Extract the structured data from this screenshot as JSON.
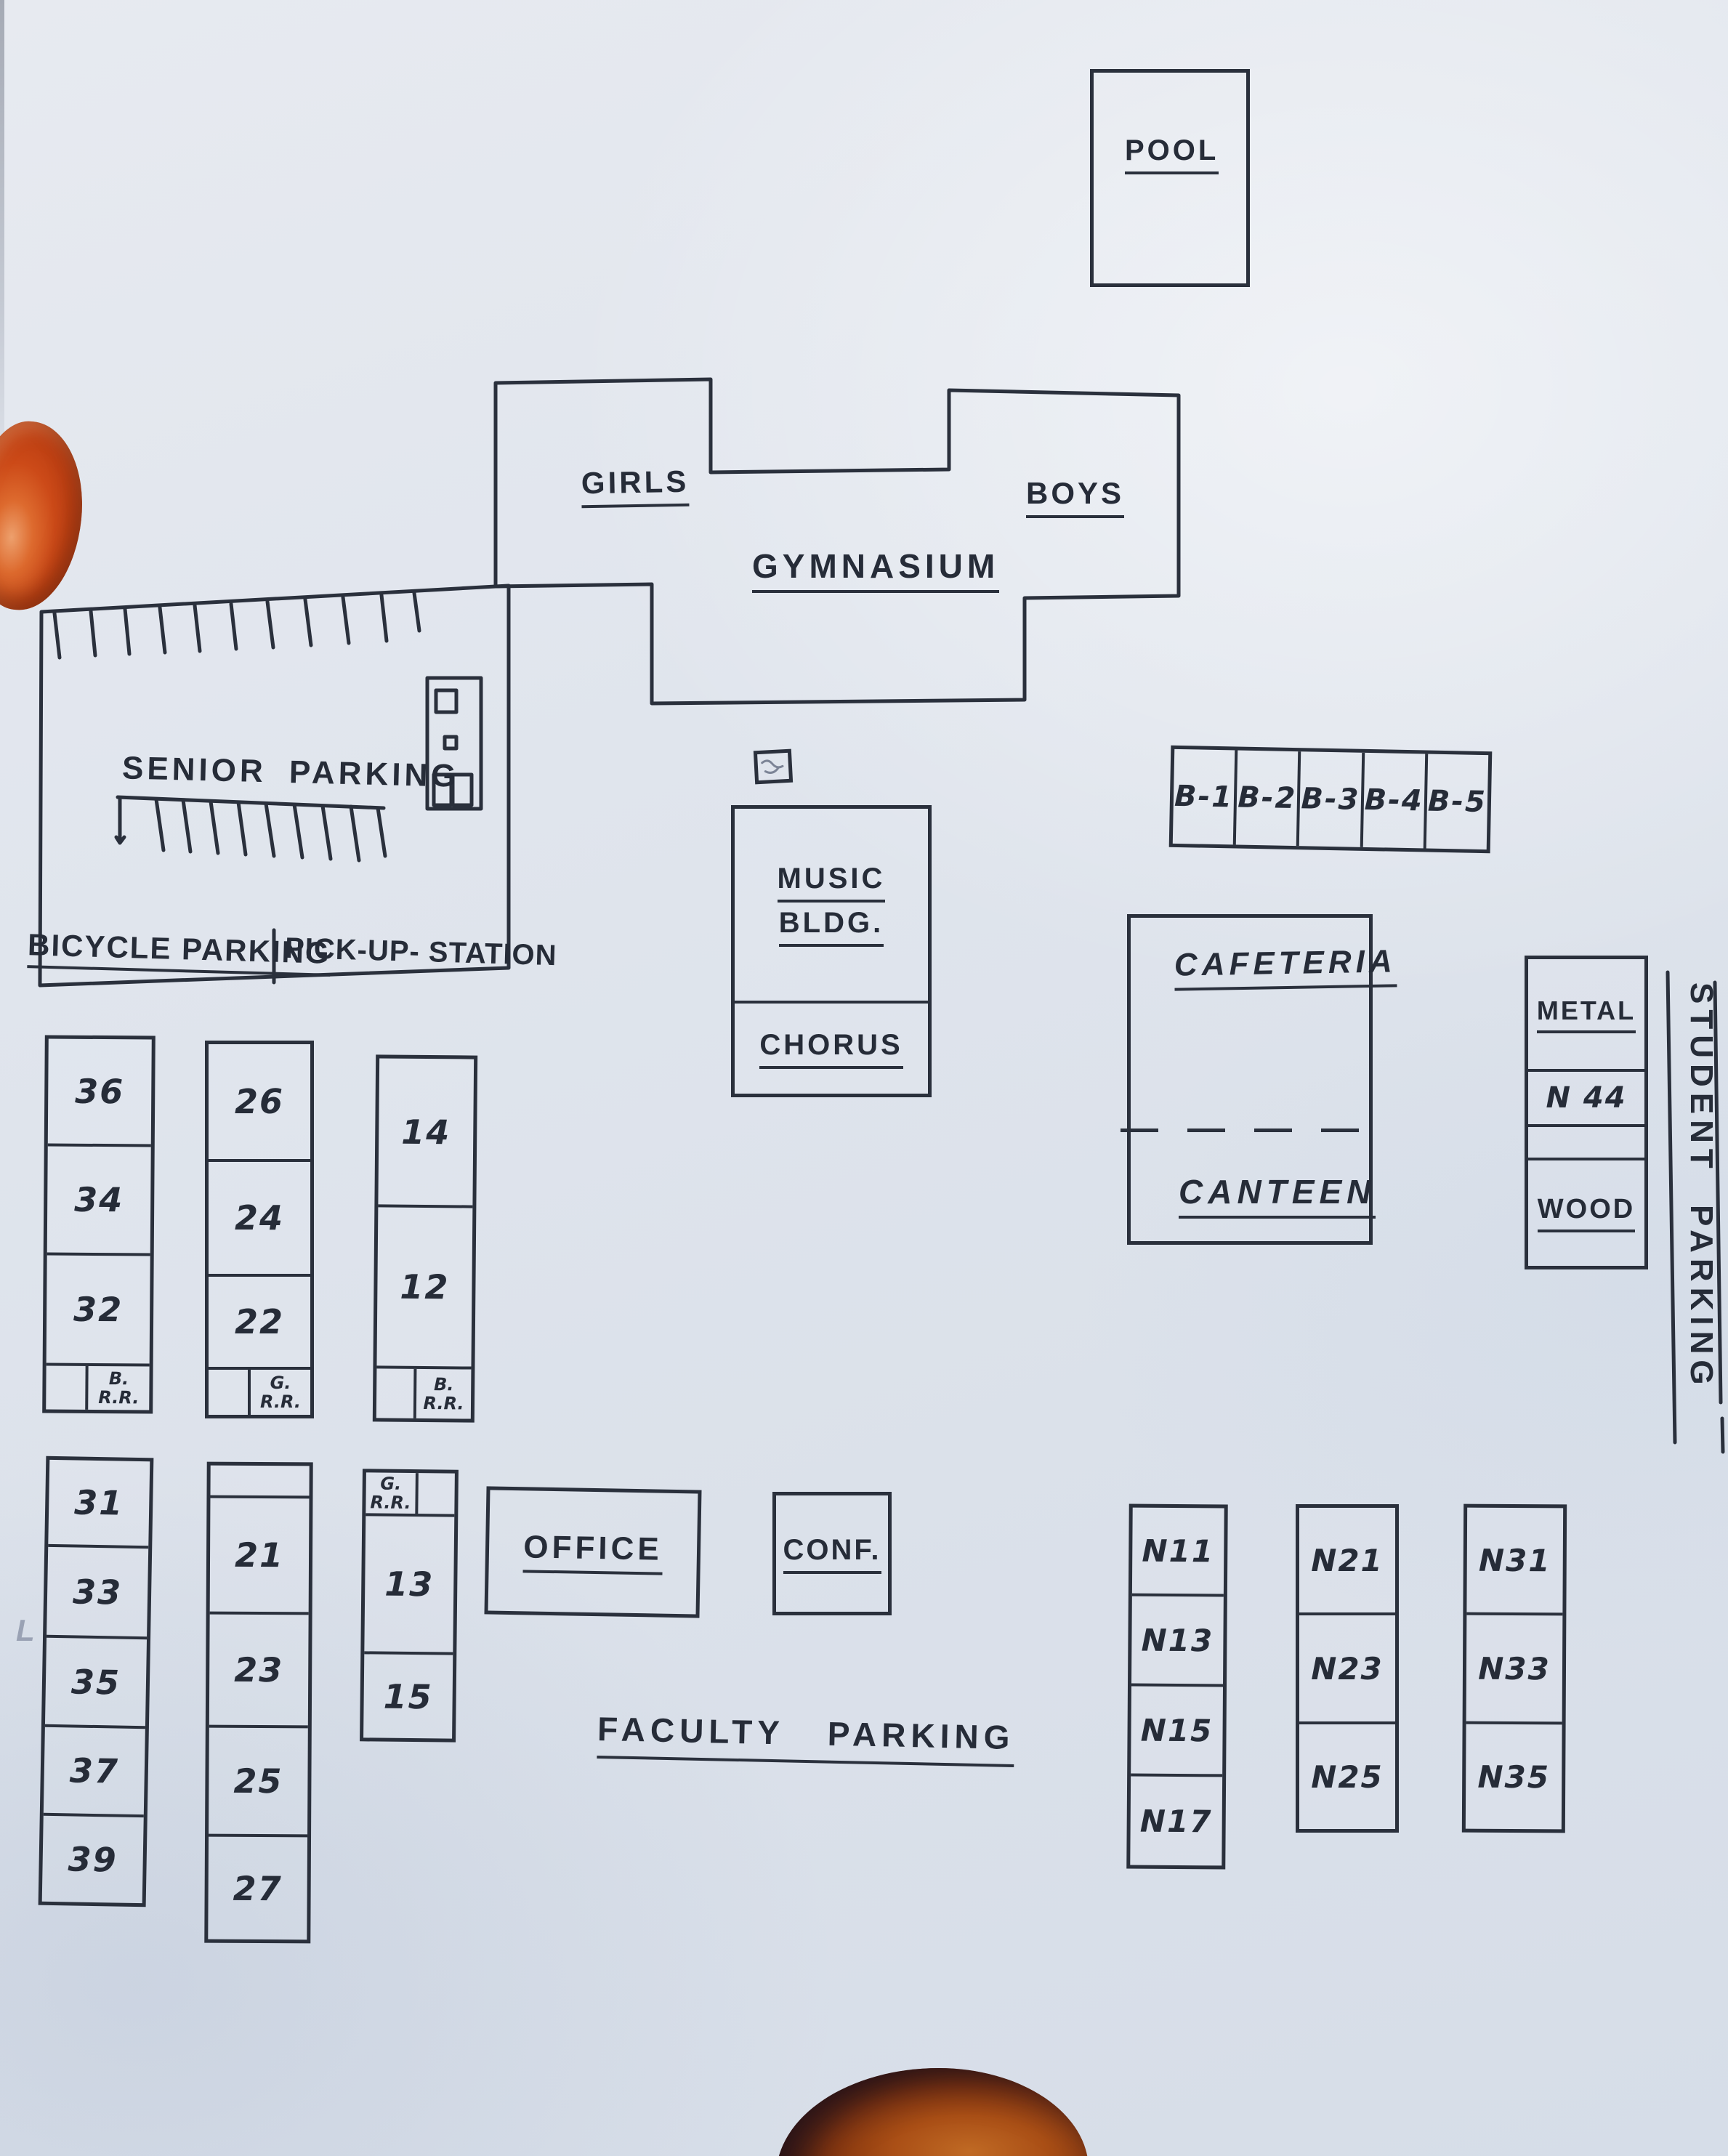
{
  "palette": {
    "ink": "#2a303c",
    "paper": "#dde3ec"
  },
  "buildings": {
    "pool": "POOL",
    "gym_left": "GIRLS",
    "gym_right": "BOYS",
    "gym": "GYMNASIUM",
    "music_line1": "MUSIC",
    "music_line2": "BLDG.",
    "chorus": "CHORUS",
    "cafeteria": "CAFETERIA",
    "canteen": "CANTEEN",
    "office": "OFFICE",
    "conf": "CONF."
  },
  "parking": {
    "senior": "SENIOR PARKING",
    "bicycle": "BICYCLE PARKING",
    "pickup": "PICK-UP- STATION",
    "faculty": "FACULTY PARKING",
    "student": "STUDENT PARKING"
  },
  "shop_wing": {
    "metal": "METAL",
    "n44": "N 44",
    "wood": "WOOD"
  },
  "b_row": [
    "B-1",
    "B-2",
    "B-3",
    "B-4",
    "B-5"
  ],
  "rooms": {
    "col_36": [
      "36",
      "34",
      "32"
    ],
    "col_36_rr": "B.\nR.R.",
    "col_26": [
      "26",
      "24",
      "22"
    ],
    "col_26_rr": "G.\nR.R.",
    "col_14": [
      "14",
      "12"
    ],
    "col_14_rr": "B.\nR.R.",
    "col_31": [
      "31",
      "33",
      "35",
      "37",
      "39"
    ],
    "col_21": [
      "21",
      "23",
      "25",
      "27"
    ],
    "col_13_rr": "G.\nR.R.",
    "col_13": [
      "13",
      "15"
    ],
    "col_n1": [
      "N11",
      "N13",
      "N15",
      "N17"
    ],
    "col_n2": [
      "N21",
      "N23",
      "N25"
    ],
    "col_n3": [
      "N31",
      "N33",
      "N35"
    ]
  },
  "marks": {
    "pencil": "L"
  }
}
